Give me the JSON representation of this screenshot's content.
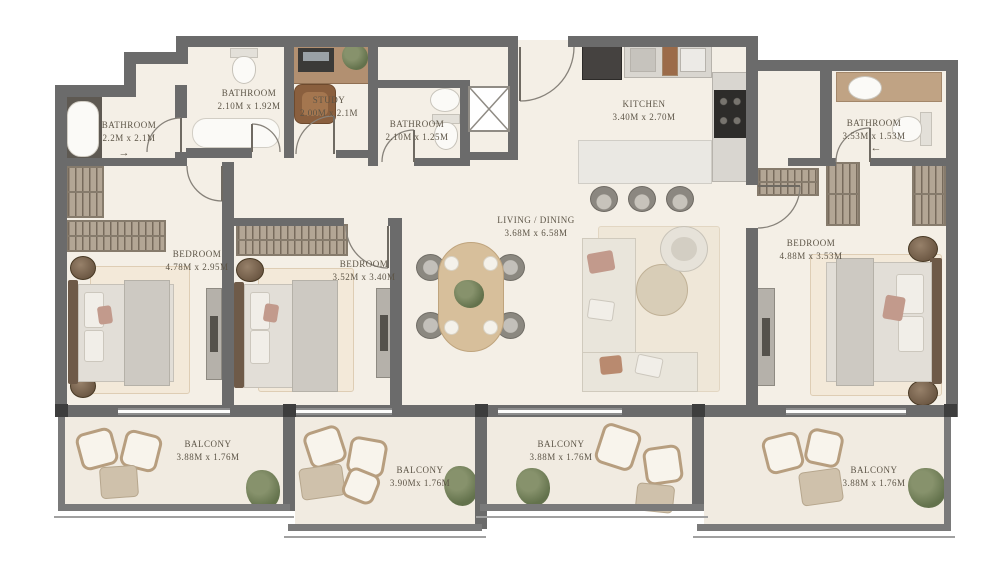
{
  "rooms": [
    {
      "id": "bathroom-1",
      "name": "BATHROOM",
      "dims": "2.2M x 2.1M"
    },
    {
      "id": "bathroom-2",
      "name": "BATHROOM",
      "dims": "2.10M x 1.92M"
    },
    {
      "id": "study",
      "name": "STUDY",
      "dims": "2.00M x 2.1M"
    },
    {
      "id": "bathroom-3",
      "name": "BATHROOM",
      "dims": "2.10M x 1.25M"
    },
    {
      "id": "kitchen",
      "name": "KITCHEN",
      "dims": "3.40M x 2.70M"
    },
    {
      "id": "bathroom-4",
      "name": "BATHROOM",
      "dims": "3.53M x 1.53M"
    },
    {
      "id": "bedroom-1",
      "name": "BEDROOM",
      "dims": "4.78M x 2.95M"
    },
    {
      "id": "bedroom-2",
      "name": "BEDROOM",
      "dims": "3.52M x 3.40M"
    },
    {
      "id": "living-dining",
      "name": "LIVING / DINING",
      "dims": "3.68M x 6.58M"
    },
    {
      "id": "bedroom-3",
      "name": "BEDROOM",
      "dims": "4.88M x 3.53M"
    },
    {
      "id": "balcony-1",
      "name": "BALCONY",
      "dims": "3.88M x 1.76M"
    },
    {
      "id": "balcony-2",
      "name": "BALCONY",
      "dims": "3.90Mx 1.76M"
    },
    {
      "id": "balcony-3",
      "name": "BALCONY",
      "dims": "3.88M x 1.76M"
    },
    {
      "id": "balcony-4",
      "name": "BALCONY",
      "dims": "3.88M x 1.76M"
    }
  ],
  "icons": {
    "arrow_right": "→",
    "arrow_left": "←"
  },
  "colors": {
    "wall": "#6b6b6b",
    "floor": "#f4efe6",
    "balcony_floor": "#f1ebe1",
    "wardrobe": "#b3a695",
    "wood": "#b29071",
    "plant_green": "#63724c",
    "label_text": "#5c5446",
    "accent_pillow": "#c29a8c"
  }
}
